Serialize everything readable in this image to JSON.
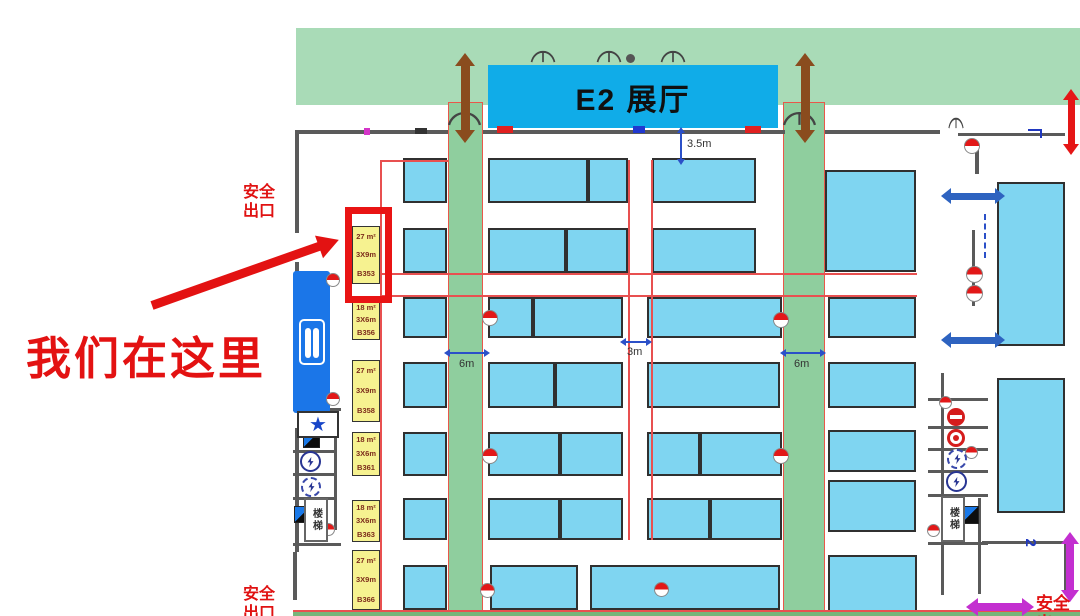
{
  "hall": {
    "name": "E2 展厅"
  },
  "annotations": {
    "we_are_here": "我们在这里",
    "exit_top_left": "安全\n出口",
    "exit_bottom_left": "安全\n出口",
    "exit_bottom_right": "安全出",
    "stairs_label": "楼梯",
    "star_glyph": "★"
  },
  "colors": {
    "ceiling_band": "#a9dbb7",
    "aisle_column": "#8fce9e",
    "booth": "#7fd5f1",
    "hall_sign": "#10ace8",
    "booth_label_bg": "#f6f290",
    "highlight_red": "#e91414",
    "dim_blue": "#2b50c8",
    "brown_arrow": "#8a4c1e",
    "magenta_arrow": "#c32fd0"
  },
  "booth_labels": [
    {
      "id": "B353",
      "area": "27 m²",
      "size": "3X9m",
      "x": 352,
      "y": 226,
      "h": 58,
      "highlighted": true
    },
    {
      "id": "B356",
      "area": "18 m²",
      "size": "3X6m",
      "x": 352,
      "y": 300,
      "h": 40,
      "highlighted": false
    },
    {
      "id": "B358",
      "area": "27 m²",
      "size": "3X9m",
      "x": 352,
      "y": 360,
      "h": 62,
      "highlighted": false
    },
    {
      "id": "B361",
      "area": "18 m²",
      "size": "3X6m",
      "x": 352,
      "y": 432,
      "h": 44,
      "highlighted": false
    },
    {
      "id": "B363",
      "area": "18 m²",
      "size": "3X6m",
      "x": 352,
      "y": 500,
      "h": 42,
      "highlighted": false
    },
    {
      "id": "B366",
      "area": "27 m²",
      "size": "3X9m",
      "x": 352,
      "y": 550,
      "h": 60,
      "highlighted": false
    }
  ],
  "booths": [
    [
      403,
      158,
      44,
      45
    ],
    [
      403,
      228,
      44,
      45
    ],
    [
      403,
      297,
      44,
      41
    ],
    [
      403,
      362,
      44,
      46
    ],
    [
      403,
      432,
      44,
      44
    ],
    [
      403,
      498,
      44,
      42
    ],
    [
      403,
      565,
      44,
      45
    ],
    [
      488,
      158,
      100,
      45
    ],
    [
      588,
      158,
      40,
      45
    ],
    [
      488,
      228,
      78,
      45
    ],
    [
      566,
      228,
      62,
      45
    ],
    [
      488,
      297,
      45,
      41
    ],
    [
      533,
      297,
      90,
      41
    ],
    [
      488,
      362,
      67,
      46
    ],
    [
      555,
      362,
      68,
      46
    ],
    [
      488,
      432,
      72,
      44
    ],
    [
      560,
      432,
      63,
      44
    ],
    [
      488,
      498,
      72,
      42
    ],
    [
      560,
      498,
      63,
      42
    ],
    [
      490,
      565,
      88,
      45
    ],
    [
      652,
      158,
      104,
      45
    ],
    [
      652,
      228,
      104,
      45
    ],
    [
      647,
      297,
      135,
      41
    ],
    [
      647,
      362,
      133,
      46
    ],
    [
      647,
      432,
      53,
      44
    ],
    [
      700,
      432,
      82,
      44
    ],
    [
      647,
      498,
      63,
      42
    ],
    [
      710,
      498,
      72,
      42
    ],
    [
      590,
      565,
      190,
      45
    ],
    [
      825,
      170,
      91,
      102
    ],
    [
      828,
      297,
      88,
      41
    ],
    [
      828,
      362,
      88,
      46
    ],
    [
      828,
      430,
      88,
      42
    ],
    [
      828,
      480,
      88,
      52
    ],
    [
      828,
      555,
      89,
      57
    ],
    [
      997,
      182,
      68,
      164
    ],
    [
      997,
      378,
      68,
      135
    ]
  ],
  "green_columns": [
    {
      "x": 448,
      "w": 35
    },
    {
      "x": 783,
      "w": 42
    }
  ],
  "walls": [
    [
      296,
      130,
      152,
      4
    ],
    [
      483,
      130,
      302,
      4
    ],
    [
      825,
      130,
      115,
      4
    ],
    [
      958,
      133,
      107,
      3
    ],
    [
      295,
      130,
      4,
      103
    ],
    [
      295,
      262,
      4,
      146
    ],
    [
      295,
      428,
      4,
      124
    ],
    [
      293,
      552,
      4,
      48
    ],
    [
      975,
      150,
      4,
      24
    ],
    [
      972,
      230,
      3,
      76
    ],
    [
      941,
      373,
      3,
      222
    ],
    [
      928,
      398,
      60,
      3
    ],
    [
      928,
      426,
      60,
      3
    ],
    [
      928,
      448,
      60,
      3
    ],
    [
      928,
      470,
      60,
      3
    ],
    [
      928,
      494,
      60,
      3
    ],
    [
      928,
      542,
      60,
      3
    ],
    [
      978,
      498,
      3,
      96
    ],
    [
      982,
      541,
      86,
      3
    ],
    [
      1064,
      541,
      4,
      52
    ],
    [
      334,
      430,
      3,
      100
    ],
    [
      293,
      408,
      48,
      3
    ],
    [
      293,
      450,
      41,
      3
    ],
    [
      293,
      473,
      41,
      3
    ],
    [
      293,
      497,
      41,
      3
    ],
    [
      293,
      543,
      48,
      3
    ]
  ],
  "red_lines": [
    [
      380,
      160,
      1.5,
      452
    ],
    [
      380,
      160,
      68,
      1.5
    ],
    [
      380,
      273,
      537,
      1.5
    ],
    [
      380,
      295,
      537,
      1.5
    ],
    [
      628,
      160,
      1.5,
      380
    ],
    [
      651,
      160,
      1.5,
      380
    ]
  ],
  "icons": [
    {
      "type": "door-arc",
      "x": 530,
      "y": 50,
      "w": 26,
      "h": 13
    },
    {
      "type": "door-arc",
      "x": 596,
      "y": 50,
      "w": 26,
      "h": 13
    },
    {
      "type": "door-arc",
      "x": 660,
      "y": 50,
      "w": 26,
      "h": 13
    },
    {
      "type": "door-arc",
      "x": 447,
      "y": 111,
      "w": 35,
      "h": 15
    },
    {
      "type": "door-arc",
      "x": 782,
      "y": 111,
      "w": 35,
      "h": 15
    },
    {
      "type": "door-arc",
      "x": 948,
      "y": 117,
      "w": 16,
      "h": 12
    },
    {
      "type": "dot",
      "x": 626,
      "y": 54,
      "w": 9,
      "h": 9
    },
    {
      "type": "tick-red",
      "x": 497,
      "y": 126,
      "w": 16,
      "h": 7
    },
    {
      "type": "tick-red",
      "x": 745,
      "y": 126,
      "w": 16,
      "h": 7
    },
    {
      "type": "tick-blue",
      "x": 633,
      "y": 126,
      "w": 12,
      "h": 7
    },
    {
      "type": "tick-dark",
      "x": 415,
      "y": 128,
      "w": 12,
      "h": 6
    },
    {
      "type": "tick-magenta",
      "x": 364,
      "y": 128,
      "w": 6,
      "h": 7
    },
    {
      "type": "hydrant",
      "x": 482,
      "y": 310,
      "w": 16
    },
    {
      "type": "hydrant",
      "x": 773,
      "y": 312,
      "w": 16
    },
    {
      "type": "hydrant",
      "x": 482,
      "y": 448,
      "w": 16
    },
    {
      "type": "hydrant",
      "x": 773,
      "y": 448,
      "w": 16
    },
    {
      "type": "hydrant",
      "x": 480,
      "y": 583,
      "w": 15
    },
    {
      "type": "hydrant",
      "x": 654,
      "y": 582,
      "w": 15
    },
    {
      "type": "hydrant",
      "x": 964,
      "y": 138,
      "w": 16
    },
    {
      "type": "hydrant",
      "x": 966,
      "y": 266,
      "w": 17
    },
    {
      "type": "hydrant",
      "x": 966,
      "y": 285,
      "w": 17
    },
    {
      "type": "hydrant",
      "x": 326,
      "y": 273,
      "w": 14
    },
    {
      "type": "hydrant",
      "x": 326,
      "y": 392,
      "w": 14
    },
    {
      "type": "hydrant",
      "x": 322,
      "y": 523,
      "w": 13
    },
    {
      "type": "hydrant",
      "x": 939,
      "y": 396,
      "w": 13
    },
    {
      "type": "hydrant",
      "x": 965,
      "y": 446,
      "w": 13
    },
    {
      "type": "hydrant",
      "x": 927,
      "y": 524,
      "w": 13
    },
    {
      "type": "no-entry",
      "x": 947,
      "y": 408,
      "w": 18
    },
    {
      "type": "red-dot-ring",
      "x": 947,
      "y": 429,
      "w": 18
    },
    {
      "type": "dashed-ring-bolt",
      "x": 947,
      "y": 449,
      "w": 20
    },
    {
      "type": "dashed-ring-bolt",
      "x": 301,
      "y": 477,
      "w": 20
    },
    {
      "type": "ring-bolt",
      "x": 946,
      "y": 471,
      "w": 21
    },
    {
      "type": "ring-bolt",
      "x": 300,
      "y": 451,
      "w": 21
    },
    {
      "type": "elec",
      "x": 303,
      "y": 431,
      "w": 17
    },
    {
      "type": "elec",
      "x": 294,
      "y": 506,
      "w": 17
    },
    {
      "type": "elec",
      "x": 961,
      "y": 506,
      "w": 18
    },
    {
      "type": "star-box",
      "x": 297,
      "y": 411,
      "w": 42,
      "h": 27
    },
    {
      "type": "stairs",
      "x": 304,
      "y": 498,
      "w": 24,
      "h": 44
    },
    {
      "type": "stairs",
      "x": 941,
      "y": 496,
      "w": 24,
      "h": 46
    },
    {
      "type": "bluehook",
      "x": 1028,
      "y": 129,
      "w": 14,
      "h": 9
    },
    {
      "type": "dashline-v",
      "x": 984,
      "y": 214,
      "w": 2,
      "h": 44
    }
  ],
  "arrows": [
    {
      "name": "loading-arrow-left",
      "dir": "v",
      "x": 465,
      "y": 66,
      "len": 64,
      "t": 9,
      "head": 13,
      "c": "#8a4c1e"
    },
    {
      "name": "loading-arrow-right",
      "dir": "v",
      "x": 805,
      "y": 66,
      "len": 64,
      "t": 9,
      "head": 13,
      "c": "#8a4c1e"
    },
    {
      "name": "exit-arrow-top-right",
      "dir": "v",
      "x": 1071,
      "y": 100,
      "len": 44,
      "t": 7,
      "head": 11,
      "c": "#e51616"
    },
    {
      "name": "exit-arrow-bottom-right-v",
      "dir": "v",
      "x": 1070,
      "y": 544,
      "len": 46,
      "t": 8,
      "head": 12,
      "c": "#c32fd0"
    },
    {
      "name": "exit-arrow-bottom-right-h",
      "dir": "h",
      "x": 978,
      "y": 607,
      "len": 44,
      "t": 8,
      "head": 12,
      "c": "#c32fd0"
    },
    {
      "name": "flow-arrow-right-1",
      "dir": "h",
      "x": 951,
      "y": 196,
      "len": 44,
      "t": 7,
      "head": 10,
      "c": "#2e63c0"
    },
    {
      "name": "flow-arrow-right-2",
      "dir": "h",
      "x": 951,
      "y": 340,
      "len": 44,
      "t": 7,
      "head": 10,
      "c": "#2e63c0"
    },
    {
      "name": "dim-arrow-3_5m",
      "dir": "v",
      "x": 681,
      "y": 133,
      "len": 26,
      "t": 2.5,
      "head": 6,
      "c": "#2b50c8"
    },
    {
      "name": "dim-arrow-6m-left",
      "dir": "h",
      "x": 450,
      "y": 353,
      "len": 34,
      "t": 2.5,
      "head": 6,
      "c": "#2b50c8"
    },
    {
      "name": "dim-arrow-6m-right",
      "dir": "h",
      "x": 786,
      "y": 353,
      "len": 34,
      "t": 2.5,
      "head": 6,
      "c": "#2b50c8"
    },
    {
      "name": "dim-arrow-3m",
      "dir": "h",
      "x": 626,
      "y": 342,
      "len": 20,
      "t": 2.5,
      "head": 6,
      "c": "#2b50c8"
    }
  ],
  "texts": [
    {
      "name": "dim-label-3-5m",
      "x": 687,
      "y": 138,
      "text": "3.5m",
      "size": 11,
      "c": "#333"
    },
    {
      "name": "dim-label-6m-left",
      "x": 459,
      "y": 358,
      "text": "6m",
      "size": 11,
      "c": "#333"
    },
    {
      "name": "dim-label-6m-right",
      "x": 794,
      "y": 358,
      "text": "6m",
      "size": 11,
      "c": "#333"
    },
    {
      "name": "dim-label-3m",
      "x": 627,
      "y": 346,
      "text": "3m",
      "size": 11,
      "c": "#333"
    },
    {
      "name": "rotated-2-label",
      "x": 1026,
      "y": 534,
      "text": "2",
      "size": 15,
      "c": "#2038c0",
      "bold": true,
      "rot": 90
    }
  ]
}
